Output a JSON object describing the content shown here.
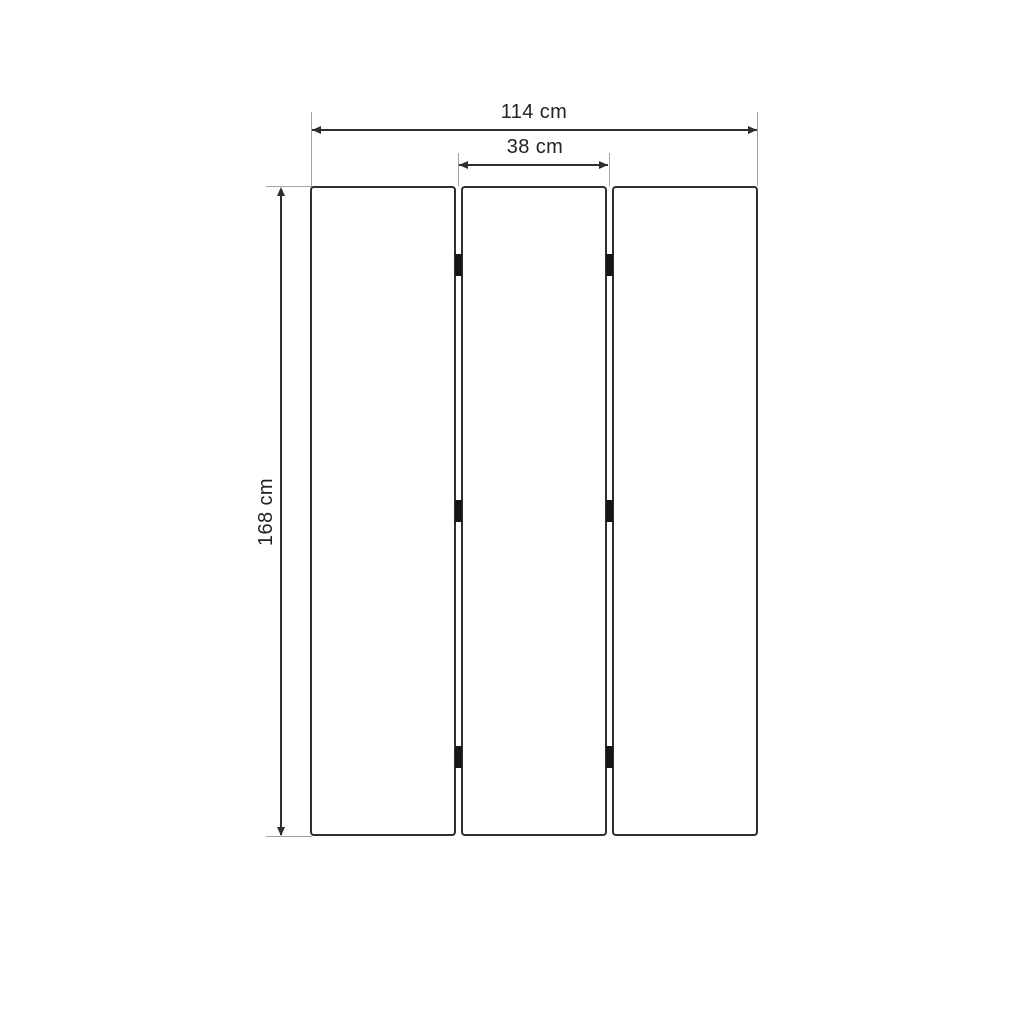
{
  "diagram": {
    "type": "furniture-dimension-drawing",
    "subject": "three-panel folding screen, front view",
    "labels": {
      "total_width": "114 cm",
      "panel_width": "38 cm",
      "height": "168 cm"
    },
    "values_cm": {
      "total_width": 114,
      "panel_width": 38,
      "height": 168
    },
    "panels": {
      "count": 3,
      "gaps": 2,
      "hinges_per_gap": 3
    },
    "colors": {
      "background": "#ffffff",
      "panel_outline": "#2e2e2e",
      "dimension_line": "#2e2e2e",
      "extension_line": "#a3a3a3",
      "hinge": "#161616",
      "label_text": "#232323"
    }
  }
}
